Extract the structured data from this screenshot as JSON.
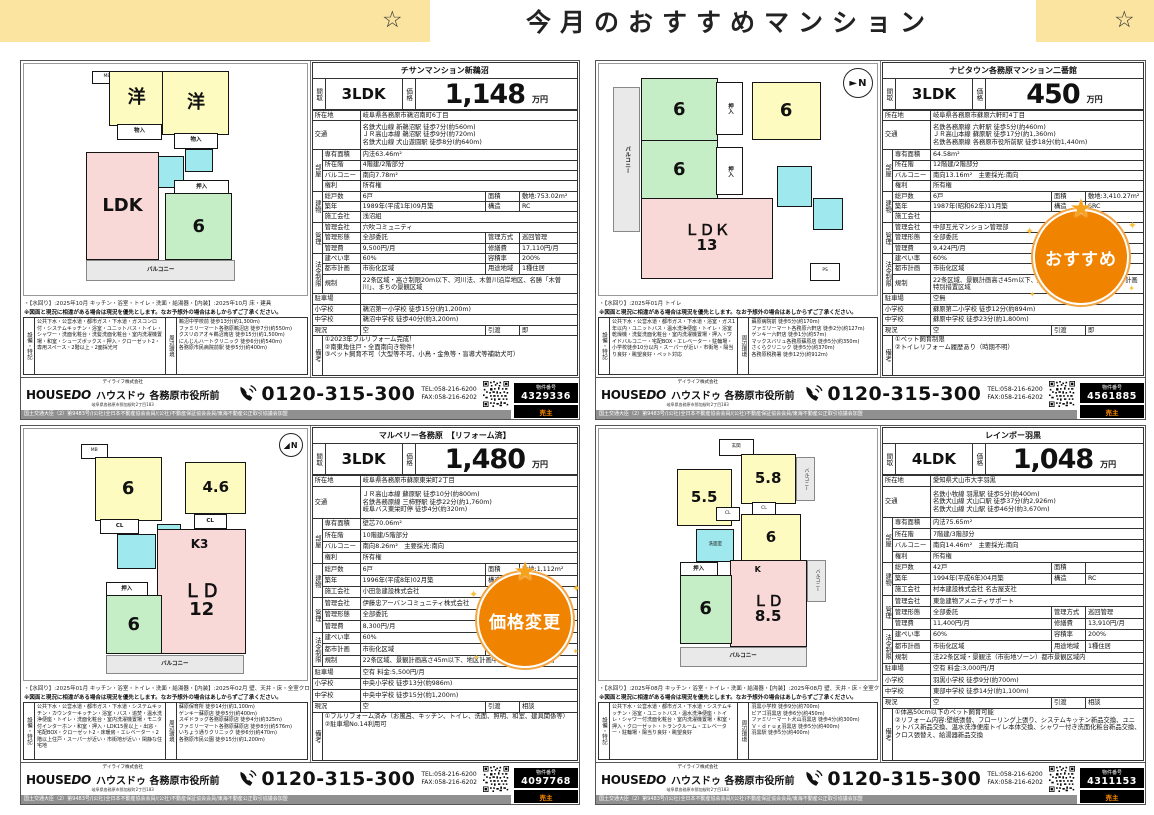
{
  "header": {
    "star": "☆",
    "title": "今月のおすすめマンション"
  },
  "labels": {
    "madori": "間取",
    "kakaku": "価格",
    "man_yen": "万円",
    "shozaichi": "所在地",
    "kotsu": "交通",
    "heya": "部屋",
    "senyu": "専有面積",
    "shozaikai": "所在階",
    "balcony": "バルコニー",
    "kenri": "権利",
    "tatemono": "建物",
    "soukosu": "総戸数",
    "menseki": "面積",
    "chikunen": "築年",
    "kozo": "構造",
    "sekou": "施工会社",
    "kanri": "管理",
    "kanri_kaisha": "管理会社",
    "kanri_keitai": "管理形態",
    "kanri_hoshiki": "管理方式",
    "kanri_hi": "管理費",
    "shuzen_hi": "修繕費",
    "horei": "法令制限",
    "kenpei": "建ぺい率",
    "yoseki": "容積率",
    "toshi": "都市計画",
    "yoto": "用途地域",
    "kisei": "規制",
    "chusha": "駐車場",
    "shogakko": "小学校",
    "chugakko": "中学校",
    "genkyo": "現況",
    "hikiwatashi": "引渡",
    "biko": "備考",
    "setsubi": "設備・特記",
    "shuhen": "周辺環境"
  },
  "note_line": "※図面と現況に相違がある場合は現況を優先とします。なお予想外の場合はあしからずご了承ください。",
  "legal": "国土交通大臣（2）第9483号/(公社)全日本不動産協会会員/(公社)不動産保証協会会員/東海不動産公正取引協議会加盟",
  "footer": {
    "company": "デイライフ株式会社",
    "brand1": "HOUSE",
    "brand2": "DO",
    "brand_jp": "ハウスドゥ 各務原市役所前",
    "addr": "岐阜県各務原市那加桜町2丁目183",
    "phone": "0120-315-300",
    "tel": "TEL:058-216-6200",
    "fax": "FAX:058-216-6202",
    "bukken_label": "物件番号",
    "seller": "売主"
  },
  "listings": [
    {
      "title": "チサンマンション新鵜沼",
      "layout": "3LDK",
      "price": "1,148",
      "address": "岐阜県各務原市鵜沼南町6丁目",
      "access": "名鉄犬山線 新鵜沼駅 徒歩7分(約560m)\nＪＲ高山本線 鵜沼駅 徒歩9分(約720m)\n名鉄犬山線 犬山遊園駅 徒歩8分(約640m)",
      "senyu": "内法63.46m²",
      "floor": "4階建/2階部分",
      "balcony": "南向7.78m²",
      "kenri": "所有権",
      "units": "6戸",
      "site_area": "敷地:753.02m²",
      "built": "1989年(平成1年)09月築",
      "structure": "RC",
      "builder": "浅沼組",
      "mgmt_co": "穴吹コミュニティ",
      "mgmt_form": "全部委託",
      "mgmt_way": "巡回管理",
      "mgmt_fee": "9,500円/月",
      "repair_fee": "17,110円/月",
      "kenpei": "60%",
      "yoseki": "200%",
      "city_plan": "市街化区域",
      "yoto": "1種住居",
      "kisei": "22条区域・高さ制限20m以下、河川法、木曽川沿岸地区、名勝「木曽川」、まちの景観区域",
      "parking": "",
      "elementary": "鵜沼第一小学校 徒歩15分(約1,200m)",
      "junior_high": "鵜沼中学校 徒歩40分(約3,200m)",
      "genkyo": "空",
      "hikiwatashi": "即",
      "biko": "①2023年フルリフォーム完成！\n②南東角住戸・全面南向き物件！\n③ペット飼育不可（大型等不可、小鳥・金魚等・盲導犬等補助犬可）",
      "caption": "・【水回り】:2025年10月 キッチン・浴室・トイレ・洗面・給湯器・【内装】:2025年10月 床・建具",
      "setsubi": "公共下水・公営水道・都市ガス・下水道・ガスコンロ付・システムキッチン・浴室・ユニットバス・トイレ・シャワー・洗面化粧台・洗髪洗面化粧台・室内洗濯機置場・和室・シューズボックス・押入・クローゼット2・専用スペース・2階以上・2面採光可",
      "shuhen": "鵜沼中学校前 徒歩13分(約1,300m)\nファミリーマート各務原鵜沼店 徒歩7分(約550m)\nクスリのアオキ鵜沼南店 徒歩15分(約1,500m)\nにんじんハートクリニック 徒歩6分(約540m)\n各務原市民病院前駅 徒歩5分(約400m)",
      "bukken_no": "4329336",
      "badge": "",
      "plan": {
        "mb": "MB",
        "yo": "洋",
        "mono": "物入",
        "oshi": "押入",
        "ldk": "LDK",
        "wa": "6",
        "balc": "バルコニー"
      }
    },
    {
      "title": "ナビタウン各務原マンション二番館",
      "layout": "3LDK",
      "price": "450",
      "address": "岐阜県各務原市蘇原六軒町4丁目",
      "access": "名鉄各務原線 六軒駅 徒歩5分(約460m)\nＪＲ高山本線 蘇原駅 徒歩17分(約1,360m)\n名鉄各務原線 各務原市役所前駅 徒歩18分(約1,440m)",
      "senyu": "64.58m²",
      "floor": "12階建/2階部分",
      "balcony": "南向13.16m²　主要採光:南向",
      "kenri": "所有権",
      "units": "6戸",
      "site_area": "敷地:3,410.27m²",
      "built": "1987年(昭和62年)11月築",
      "structure": "SRC",
      "builder": "",
      "mgmt_co": "中部互光マンション管理部",
      "mgmt_form": "全部委託",
      "mgmt_way": "常駐管理",
      "mgmt_fee": "9,424円/月",
      "repair_fee": "12,150円/月",
      "kenpei": "60%",
      "yoseki": "200%",
      "city_plan": "市街化区域",
      "yoto": "準工業",
      "kisei": "22条区域、景観計画高さ45m以下、航空法、まちの景観地域、都市計画特別措置区域",
      "parking": "空無",
      "elementary": "蘇原第二小学校 徒歩12分(約894m)",
      "junior_high": "蘇原中学校 徒歩23分(約1,800m)",
      "genkyo": "空",
      "hikiwatashi": "即",
      "biko": "①ペット飼育制限\n②トイレリフォーム履歴あり（時期不明）",
      "caption": "・【水回り】:2025年01月 トイレ",
      "setsubi": "公共下水・公営水道・都市ガス・下水道・浴室・ガス1年以内・ユニットバス・温水洗浄便座・トイレ・浴室乾燥機・洗髪洗面化粧台・室内洗濯機置場・押入・ワイドバルコニー・宅配BOX・エレベーター・駐輪場・小学校徒歩10分以内・スーパーが近い・市街地・陽当り良好・眺望良好・ペット対応",
      "shuhen": "蘇原病院前 徒歩5分(約170m)\nファミリーマート各務原六軒店 徒歩2分(約127m)\nゲンキー六軒店 徒歩1分(約57m)\nマックスバリュ各務原蘇原店 徒歩5分(約350m)\nさくらクリニック 徒歩5分(約370m)\n各務原税務署 徒歩12分(約912m)",
      "bukken_no": "4561885",
      "badge": "おすすめ",
      "plan": {
        "balc": "バルコニー",
        "g": "6",
        "y": "6",
        "oshi": "押入",
        "ldk": "ＬＤＫ\n13",
        "ps": "PS",
        "north": "N"
      }
    },
    {
      "title": "マルベリー各務原　【リフォーム済】",
      "layout": "3LDK",
      "price": "1,480",
      "address": "岐阜県各務原市蘇原東栄町2丁目",
      "access": "ＪＲ高山本線 蘇原駅 徒歩10分(約800m)\n名鉄各務原線 三柿野駅 徒歩22分(約1,760m)\n岐阜バス東栄町停 徒歩4分(約320m)",
      "senyu": "壁芯70.06m²",
      "floor": "10階建/5階部分",
      "balcony": "南向8.26m²　主要採光:南向",
      "kenri": "所有権",
      "units": "6戸",
      "site_area": "敷地:1,112m²",
      "built": "1996年(平成8年)02月築",
      "structure": "SRC",
      "builder": "小田急建設株式会社",
      "mgmt_co": "伊藤忠アーバンコミュニティ株式会社",
      "mgmt_form": "全部委託",
      "mgmt_way": "巡回管理",
      "mgmt_fee": "8,300円/月",
      "repair_fee": "17,300円/月",
      "kenpei": "60%",
      "yoseki": "200%",
      "city_plan": "市街化区域",
      "yoto": "準工業",
      "kisei": "22条区域、景観計画高さ45m以下、地区計画中央地区、埋蔵文化財",
      "parking": "空有 料金:5,500円/月",
      "elementary": "中央小学校 徒歩13分(約986m)",
      "junior_high": "中央中学校 徒歩15分(約1,200m)",
      "genkyo": "空",
      "hikiwatashi": "相談",
      "biko": "①フルリフォーム済み（お風呂、キッチン、トイレ、洗面、照明、和室、建具関係等）\n②駐車場No.14利用可",
      "caption": "・【水回り】:2025年01月 キッチン・浴室・トイレ・洗面・給湯器・【内装】:2025年02月 壁、天井・床・全室クロス",
      "setsubi": "公共下水・公営水道・都市ガス・下水道・システムキッチン・カウンターキッチン・浴室・バス・追焚・温水洗浄便座・トイレ・洗面化粧台・室内洗濯機置場・モニタ付インターホン・和室・押入・LDK15畳以上・出窓・宅配BOX・クローゼット2・床暖房・エレベーター・2階以上住戸・スーパーが近い・市街地が近い・閑静な住宅地",
      "shuhen": "蘇原保育所 徒歩14分(約1,100m)\nゲンキー蘇原店 徒歩5分(約400m)\nスギドラッグ各務原蘇原店 徒歩4分(約325m)\nファミリーマート各務原蘇原店 徒歩8分(約576m)\nいちょう通りクリニック 徒歩6分(約470m)\n各務原市民公園 徒歩15分(約1,200m)",
      "bukken_no": "4097768",
      "badge": "価格変更",
      "plan": {
        "mb": "MB",
        "y1": "6",
        "y2": "4.6",
        "cl": "CL",
        "oshi": "押入",
        "ld": "ＬＤ\n12",
        "k": "K3",
        "g": "6",
        "balc": "バルコニー",
        "north": "N"
      }
    },
    {
      "title": "レインボー羽黒",
      "layout": "4LDK",
      "price": "1,048",
      "address": "愛知県犬山市大字羽黒",
      "access": "名鉄小牧線 羽黒駅 徒歩5分(約400m)\n名鉄犬山線 犬山口駅 徒歩37分(約2,926m)\n名鉄犬山線 犬山駅 徒歩46分(約3,670m)",
      "senyu": "内法75.65m²",
      "floor": "7階建/3階部分",
      "balcony": "南向14.46m²　主要採光:南向",
      "kenri": "所有権",
      "units": "42戸",
      "site_area": "",
      "built": "1994年(平成6年)04月築",
      "structure": "RC",
      "builder": "村本建設株式会社 名古屋支社",
      "mgmt_co": "東急建物アメニティサポート",
      "mgmt_form": "全部委託",
      "mgmt_way": "巡回管理",
      "mgmt_fee": "11,400円/月",
      "repair_fee": "13,910円/月",
      "kenpei": "60%",
      "yoseki": "200%",
      "city_plan": "市街化区域",
      "yoto": "1種住居",
      "kisei": "法22条区域・景観法（市街地ゾーン）都市景観区域内",
      "parking": "空有 料金:3,000円/月",
      "elementary": "羽黒小学校 徒歩9分(約700m)",
      "junior_high": "東部中学校 徒歩14分(約1,100m)",
      "genkyo": "空",
      "hikiwatashi": "相談",
      "biko": "①体高50cm以下のペット飼育可能\n②リフォーム内容:壁紙張替、フローリング上張り、システムキッチン新品交換、ユニットバス新品交換、温水洗浄便座トイレ本体交換、シャワー付き洗面化粧台新品交換、クロス張替え、給湯器新品交換",
      "caption": "・【水回り】:2025年08月 キッチン・浴室・トイレ・洗面・給湯器・【内装】:2025年08月 壁、天井・床・全室クロス・建具・サッシ",
      "setsubi": "公共下水・公営水道・都市ガス・下水道・システムキッチン・浴室・ユニットバス・温水洗浄便座・トイレ・シャワー付洗面化粧台・室内洗濯機置場・和室・押入・クローゼット・トランクルーム・エレベーター・駐輪場・陽当り良好・眺望良好",
      "shuhen": "羽黒小学校 徒歩9分(約700m)\nピアゴ羽黒店 徒歩6分(約450m)\nファミリーマート犬山羽黒店 徒歩4分(約300m)\nＶ・ｄｒｕｇ羽黒店 徒歩5分(約400m)\n羽黒駅 徒歩5分(約400m)",
      "bukken_no": "4311153",
      "badge": "",
      "plan": {
        "genkan": "玄関",
        "y58": "5.8",
        "y55": "5.5",
        "y6": "6",
        "cl": "CL",
        "oshi": "押入",
        "ld": "ＬＤ\n8.5",
        "k": "K",
        "g": "6",
        "balc": "バルコニー",
        "senmen": "洗面室"
      }
    }
  ]
}
